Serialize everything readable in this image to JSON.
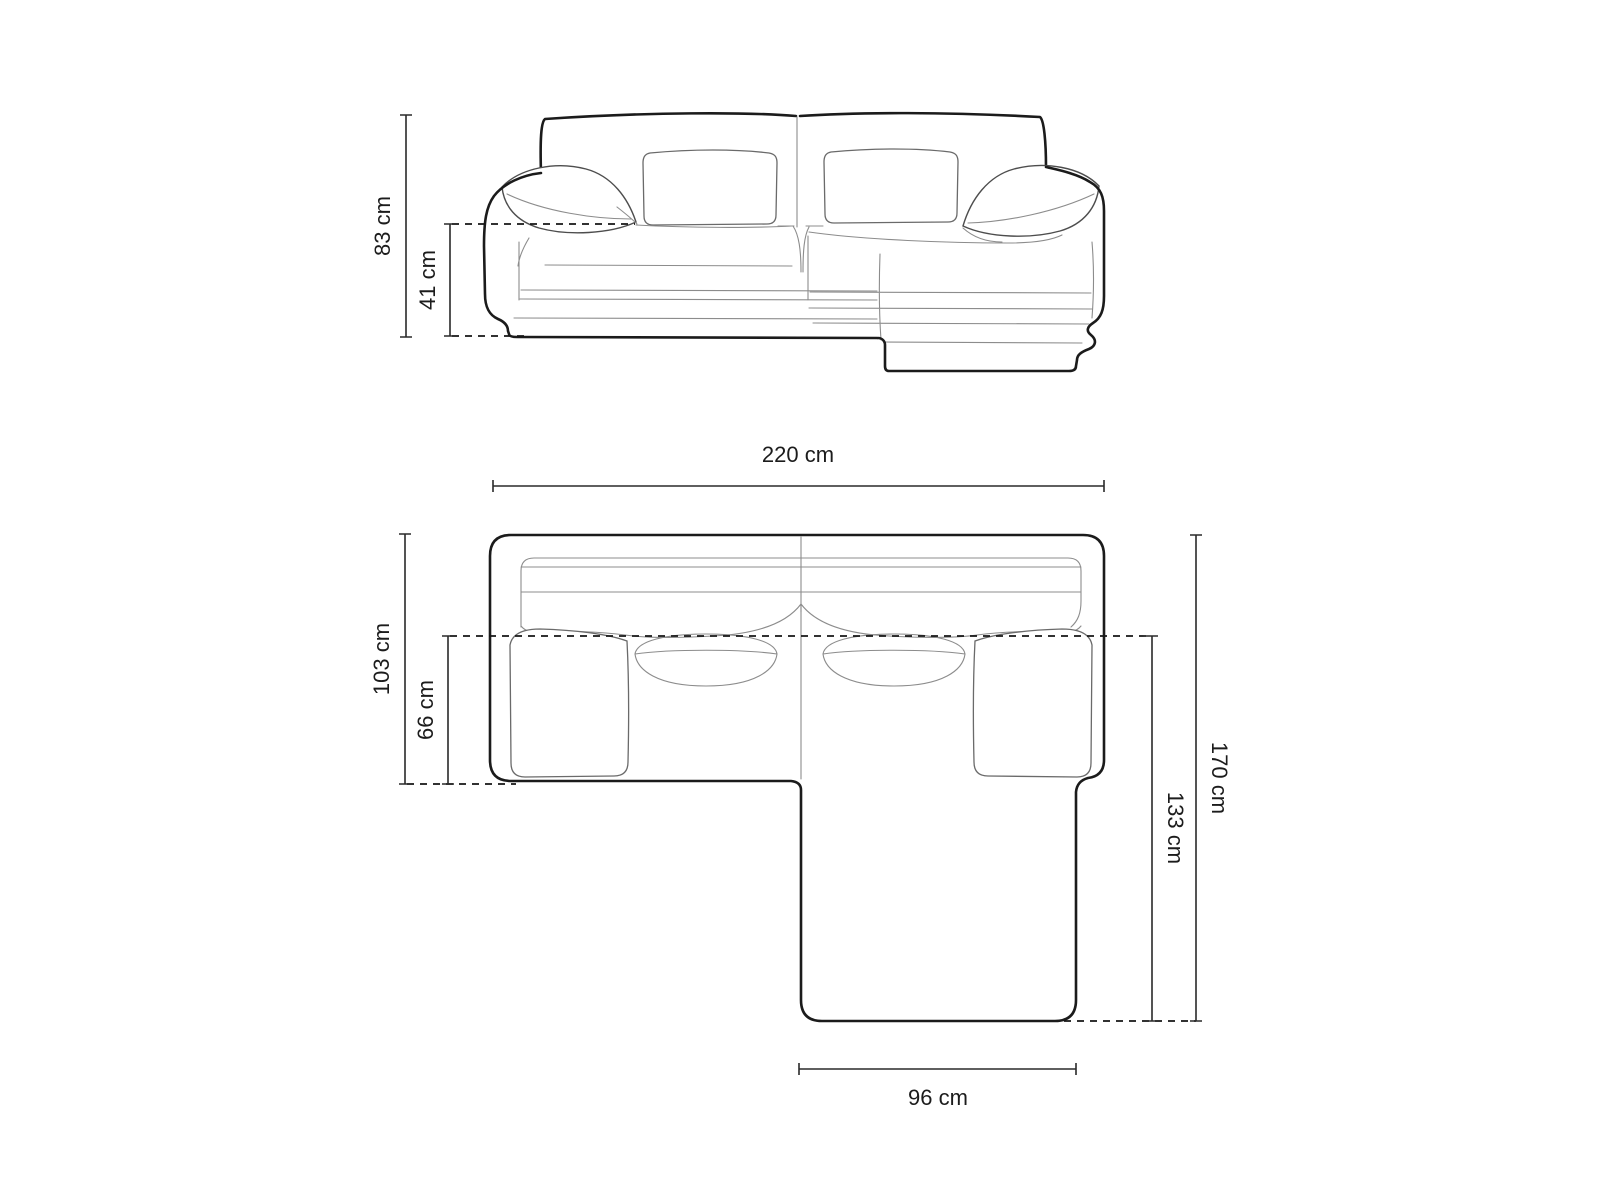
{
  "diagram": {
    "description": "Technical dimension drawing of a corner sofa with right-hand chaise: front elevation above, top plan below",
    "unit": "cm",
    "front_view": {
      "dims": {
        "total_height": "83 cm",
        "seat_height": "41 cm"
      }
    },
    "top_view": {
      "dims": {
        "total_width": "220 cm",
        "body_depth": "103 cm",
        "seat_depth": "66 cm",
        "total_depth": "170 cm",
        "chaise_depth": "133 cm",
        "chaise_width": "96 cm"
      }
    },
    "colors": {
      "background": "#ffffff",
      "outline": "#1b1b1b",
      "detail_line": "#8c8c8c",
      "dimension_line": "#2a2a2a",
      "label_text": "#1c1c1c"
    }
  }
}
